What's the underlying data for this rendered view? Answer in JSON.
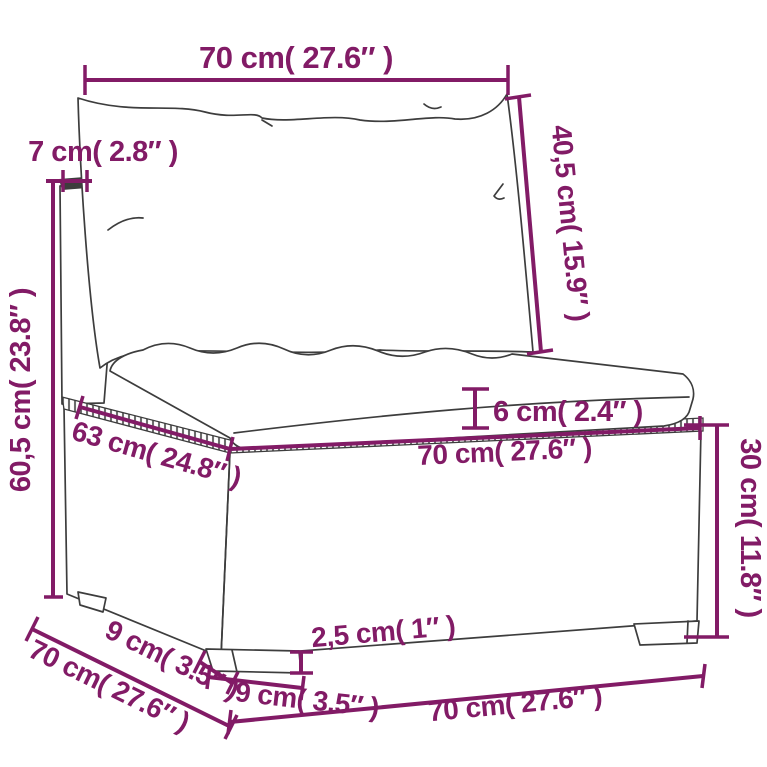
{
  "figure": {
    "description": "Technical dimension diagram of a poly rattan modular sofa middle section with back cushion, seat cushion, woven base and feet",
    "accent_color": "#821b66",
    "sketch_color": "#3d3d3d",
    "background_color": "#ffffff"
  },
  "labels": {
    "back_cushion_width": "70 cm( 27.6″ )",
    "back_panel_thickness": "7 cm( 2.8″ )",
    "back_cushion_height": "40,5 cm( 15.9″ )",
    "back_total_height": "60,5 cm( 23.8″ )",
    "seat_cushion_thickness": "6 cm( 2.4″ )",
    "seat_depth": "63 cm( 24.8″ )",
    "seat_width": "70 cm( 27.6″ )",
    "base_height": "30 cm( 11.8″ )",
    "foot_depth": "9 cm( 3.5″ )",
    "total_depth": "70 cm( 27.6″ )",
    "foot_height": "2,5 cm( 1″ )",
    "foot_width": "9 cm( 3.5″ )",
    "base_width": "70 cm( 27.6″ )"
  }
}
